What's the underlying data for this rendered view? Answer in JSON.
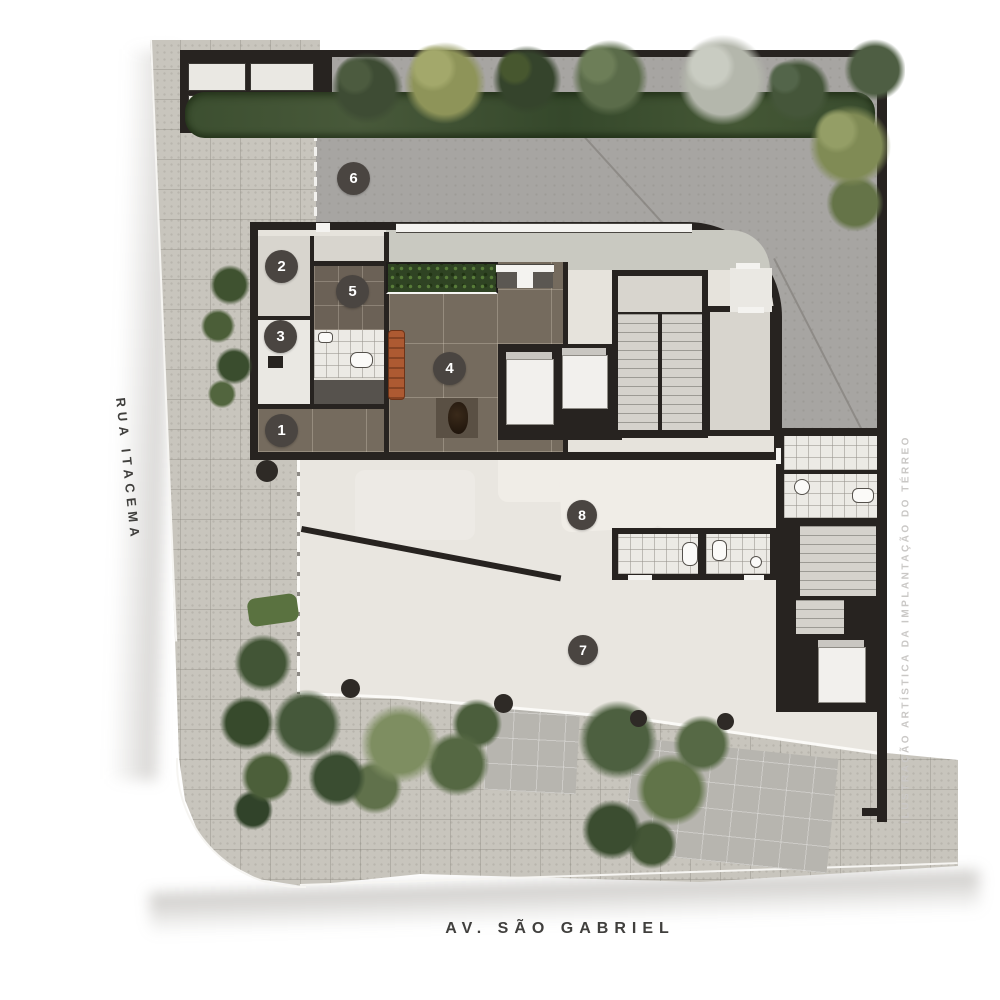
{
  "streets": {
    "left": "RUA ITACEMA",
    "bottom": "AV. SÃO GABRIEL"
  },
  "watermark": "ILUSTRAÇÃO ARTÍSTICA DA IMPLANTAÇÃO DO TÉRREO",
  "markers": [
    {
      "number": "1"
    },
    {
      "number": "2"
    },
    {
      "number": "3"
    },
    {
      "number": "4"
    },
    {
      "number": "5"
    },
    {
      "number": "6"
    },
    {
      "number": "7"
    },
    {
      "number": "8"
    }
  ],
  "colors": {
    "wall": "#272320",
    "paving": "#c8c5bd",
    "driveway": "#a7a5a2",
    "terrace_floor": "#e9e6e0",
    "lobby_floor": "#756b5e",
    "marker_bg": "#4a4541",
    "foliage_green": "#4a5d3a",
    "bench_orange": "#ad5a32"
  }
}
